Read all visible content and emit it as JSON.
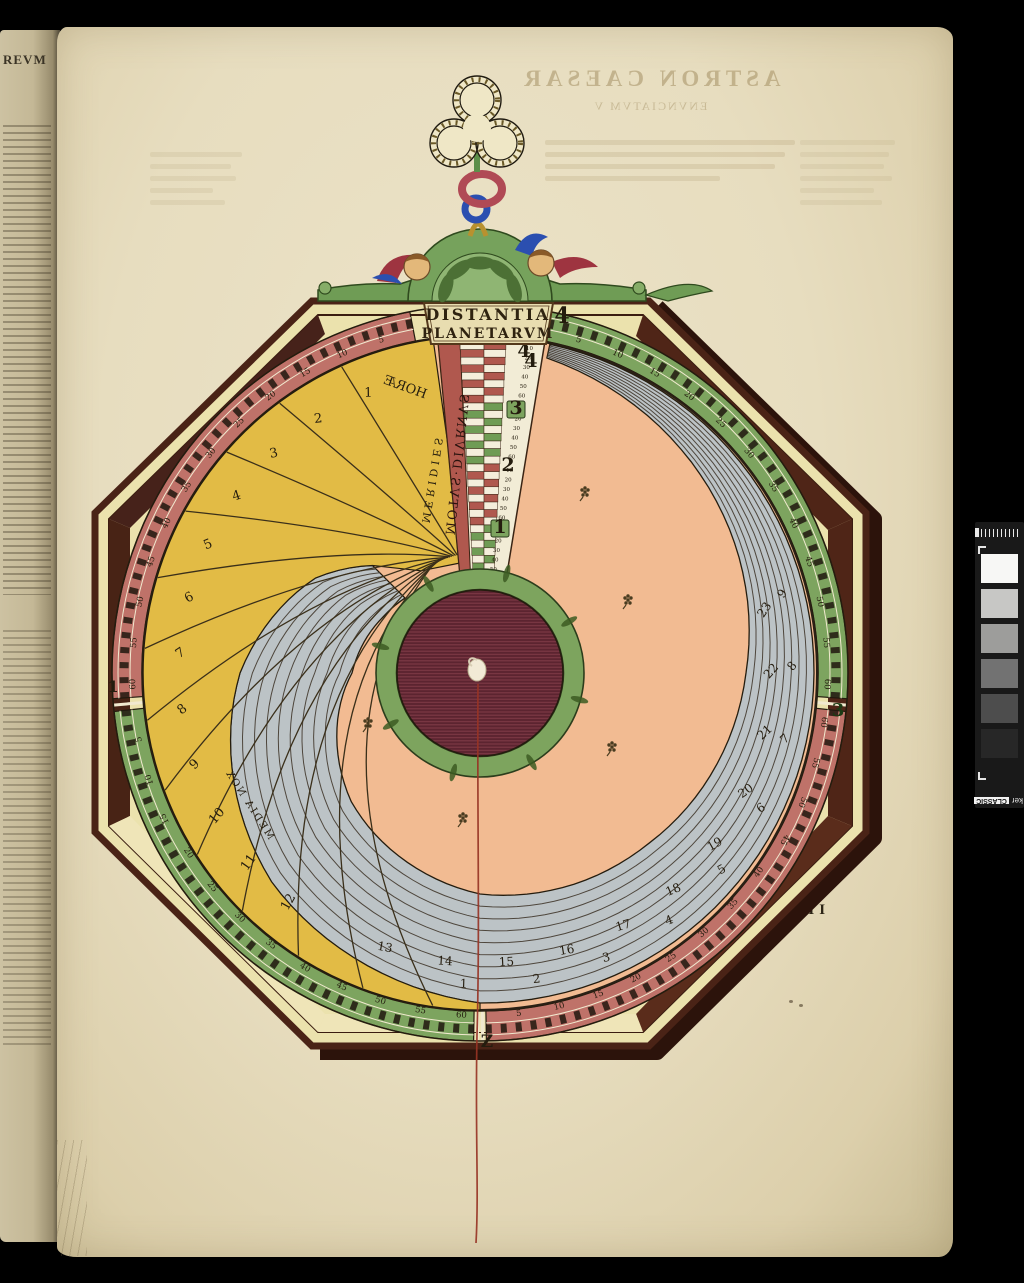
{
  "photo": {
    "background": "#000000"
  },
  "facing_page": {
    "heading": "REVM"
  },
  "main_page": {
    "signature": "G II"
  },
  "bleedthrough": {
    "line1": "ASTRON CAESAR",
    "line2": "ENVNCIATVM V"
  },
  "calibration_strip": {
    "fragment": "ker",
    "chip": "CLASSIC",
    "patches": [
      "#f7f7f5",
      "#c7c7c5",
      "#9d9d9b",
      "#727272",
      "#4d4d4d",
      "#272727"
    ]
  },
  "volvelle": {
    "title": {
      "line1": "DISTANTIA",
      "line2": "PLANETARVM"
    },
    "labels": {
      "motus_diurnus": "MOTVS·DIVRNVS",
      "meridies": "MERIDIES",
      "horae": "HORÆ",
      "media_nox": "MEDIA NOX"
    },
    "unit_numbers": [
      "4",
      "3",
      "2",
      "1"
    ],
    "quadrant_glyphs": {
      "top": "4",
      "right": "3",
      "bottom": "Z",
      "left": "1"
    },
    "minor_numbers": [
      "10",
      "20",
      "30",
      "40",
      "50",
      "60"
    ],
    "ring_tick_values": [
      "5",
      "10",
      "15",
      "20",
      "25",
      "30",
      "35",
      "40",
      "45",
      "50",
      "55",
      "60"
    ],
    "ring_segments": [
      {
        "name": "upper-left",
        "color": "#bf7269",
        "start": -11,
        "end": -94,
        "num_start": -16.5,
        "num_step": -6.85
      },
      {
        "name": "lower-left",
        "color": "#7da45f",
        "start": -96,
        "end": -179,
        "num_start": -101,
        "num_step": -6.9
      },
      {
        "name": "upper-right",
        "color": "#7da45f",
        "start": 11,
        "end": 94,
        "num_start": 16.5,
        "num_step": 6.85
      },
      {
        "name": "lower-right",
        "color": "#bf7269",
        "start": 96,
        "end": 179,
        "num_start": 173.5,
        "num_step": -6.85
      }
    ],
    "hour_labels": {
      "values": [
        "1",
        "2",
        "3",
        "4",
        "5",
        "6",
        "7",
        "8",
        "9",
        "10",
        "11",
        "12"
      ],
      "start_angle": -22,
      "step": -10.8,
      "radius": 298
    },
    "gray_inner_labels": {
      "values": [
        "13",
        "14",
        "15",
        "16",
        "17",
        "18",
        "19",
        "20",
        "21",
        "22",
        "23"
      ],
      "start_angle": 199,
      "step": -12.1,
      "radius": 294
    },
    "gray_outer_labels": {
      "values": [
        "1",
        "2",
        "3",
        "4",
        "5",
        "6",
        "7",
        "8",
        "9"
      ],
      "start_angle": 183,
      "step": -13.4,
      "radius": 315
    },
    "palette": {
      "paper": "#e8dfc2",
      "octagon_fill": "#ebe2ad",
      "frame_brown": "#4a2316",
      "frame_shadow": "#2c130b",
      "ring_red": "#bf7269",
      "ring_green": "#7da45f",
      "yellow": "#e2bb45",
      "gray_band": "#bcc3c6",
      "salmon": "#f2bb92",
      "hub_maroon": "#5c2430",
      "hub_ring_green": "#7da45e",
      "thread_red": "#973425",
      "pediment_green": "#6f9c55",
      "chain_gold": "#b8912f",
      "chain_blue": "#2b4fb0",
      "chain_red": "#b04a55",
      "chain_green": "#5d8f4a"
    }
  }
}
